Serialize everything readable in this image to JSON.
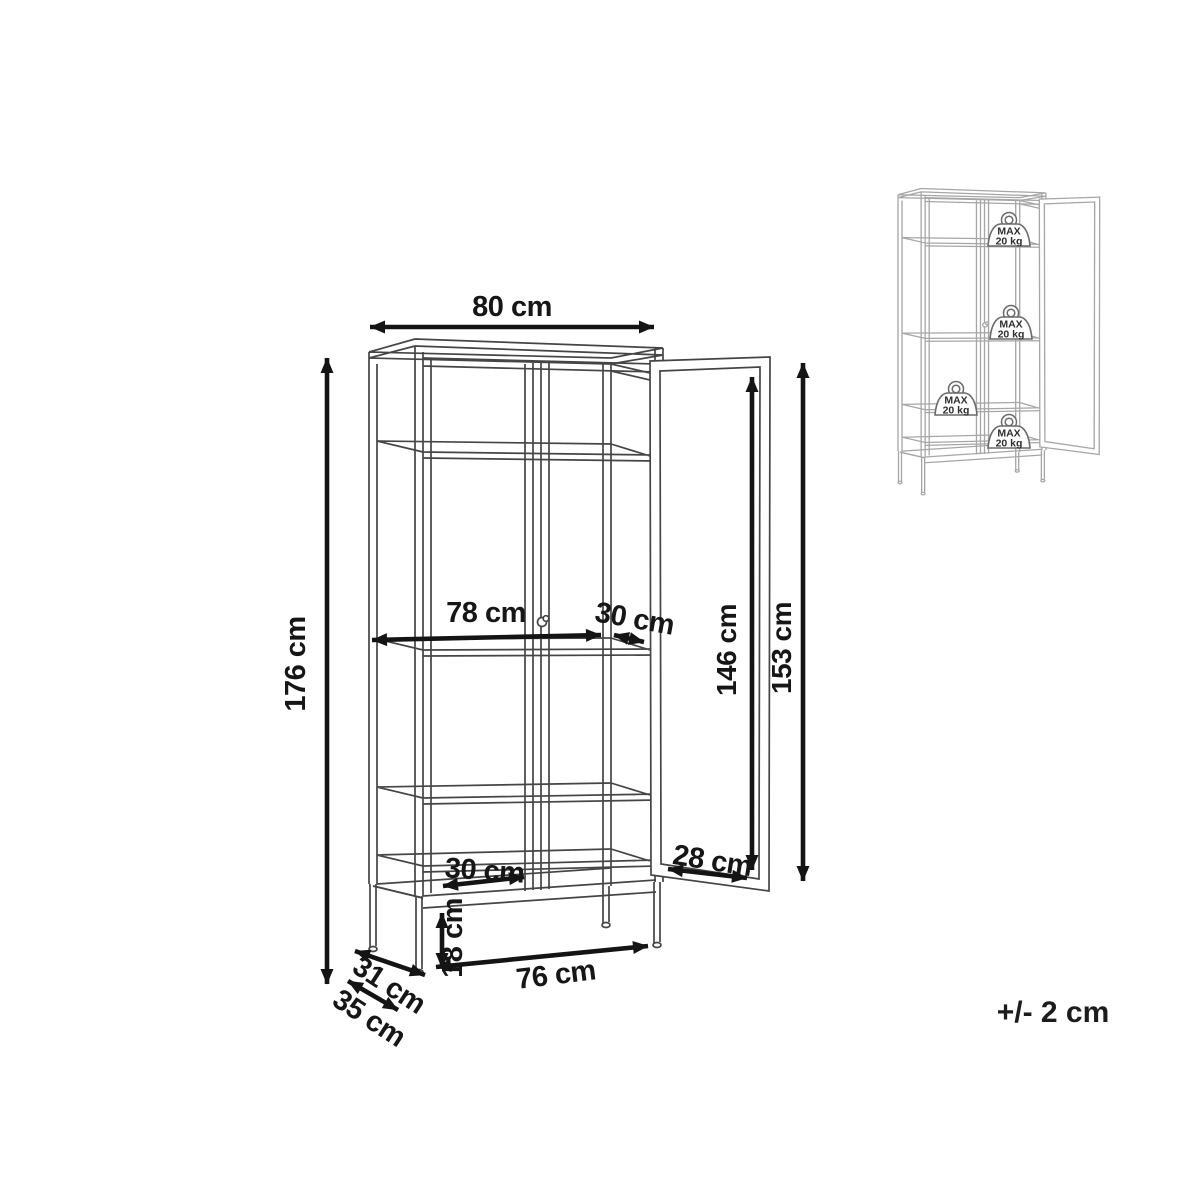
{
  "diagram": {
    "dimensions": {
      "top_width": "80 cm",
      "total_height": "176 cm",
      "interior_width": "78 cm",
      "shelf_depth": "30 cm",
      "door_glass_height": "146 cm",
      "door_height": "153 cm",
      "bottom_shelf_depth": "30 cm",
      "door_glass_width": "28 cm",
      "leg_height": "18 cm",
      "front_leg_span": "76 cm",
      "side_leg_span": "31 cm",
      "total_depth": "35 cm"
    },
    "tolerance": "+/- 2 cm"
  },
  "inset": {
    "weights": [
      {
        "line1": "MAX",
        "line2": "20 kg"
      },
      {
        "line1": "MAX",
        "line2": "20 kg"
      },
      {
        "line1": "MAX",
        "line2": "20 kg"
      },
      {
        "line1": "MAX",
        "line2": "20 kg"
      }
    ]
  },
  "colors": {
    "background": "#ffffff",
    "cabinet_line": "#454545",
    "inset_line": "#a6a6a6",
    "dimension_line": "#141414",
    "label_text": "#161616"
  }
}
